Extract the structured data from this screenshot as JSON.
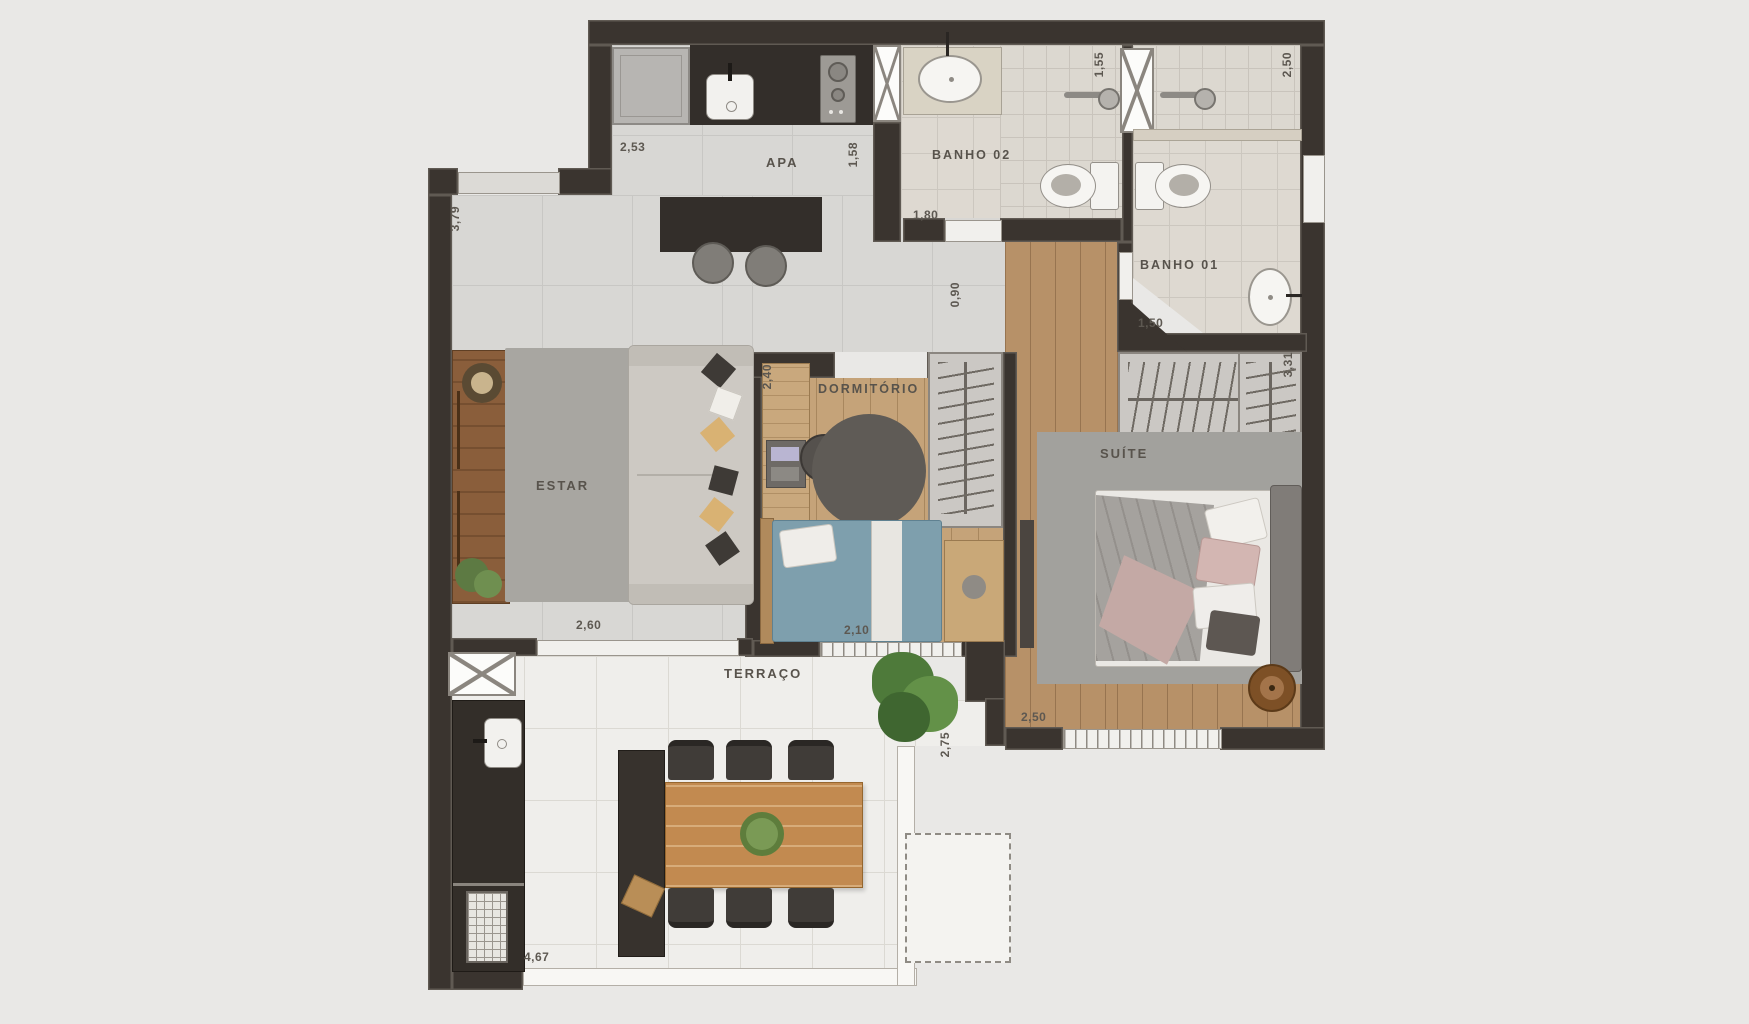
{
  "labels": {
    "apa": "APA",
    "banho02": "BANHO 02",
    "banho01": "BANHO 01",
    "estar": "ESTAR",
    "dormitorio": "DORMITÓRIO",
    "suite": "SUÍTE",
    "terraco": "TERRAÇO"
  },
  "dims": {
    "kitchen_w": "2,53",
    "kitchen_d": "1,58",
    "banho02_w": "1,55",
    "banho01_shower": "2,50",
    "banho02_door": "1,80",
    "hall_w": "0,90",
    "estar_h": "3,79",
    "banho01_door": "1,50",
    "closet_h": "3,31",
    "dorm_w": "2,40",
    "estar_door": "2,60",
    "dorm_window": "2,10",
    "suite_w": "2,50",
    "terrace_d": "2,75",
    "terrace_w": "4,67"
  },
  "colors": {
    "background": "#e9e8e6",
    "walls": "#3a342f",
    "living_tile": "#d8d7d4",
    "bath_tile": "#ded9d1",
    "terrace_tile": "#efeeeb",
    "wood_light": "#c5a379",
    "wood_dark": "#b79168",
    "dark_cabinet": "#332e2a",
    "rug_grey": "#a8a6a1",
    "bed_blue": "#7e9fad",
    "pillow_pink": "#d3b6b2",
    "table_wood": "#c28a50",
    "label_text": "#58534c"
  }
}
